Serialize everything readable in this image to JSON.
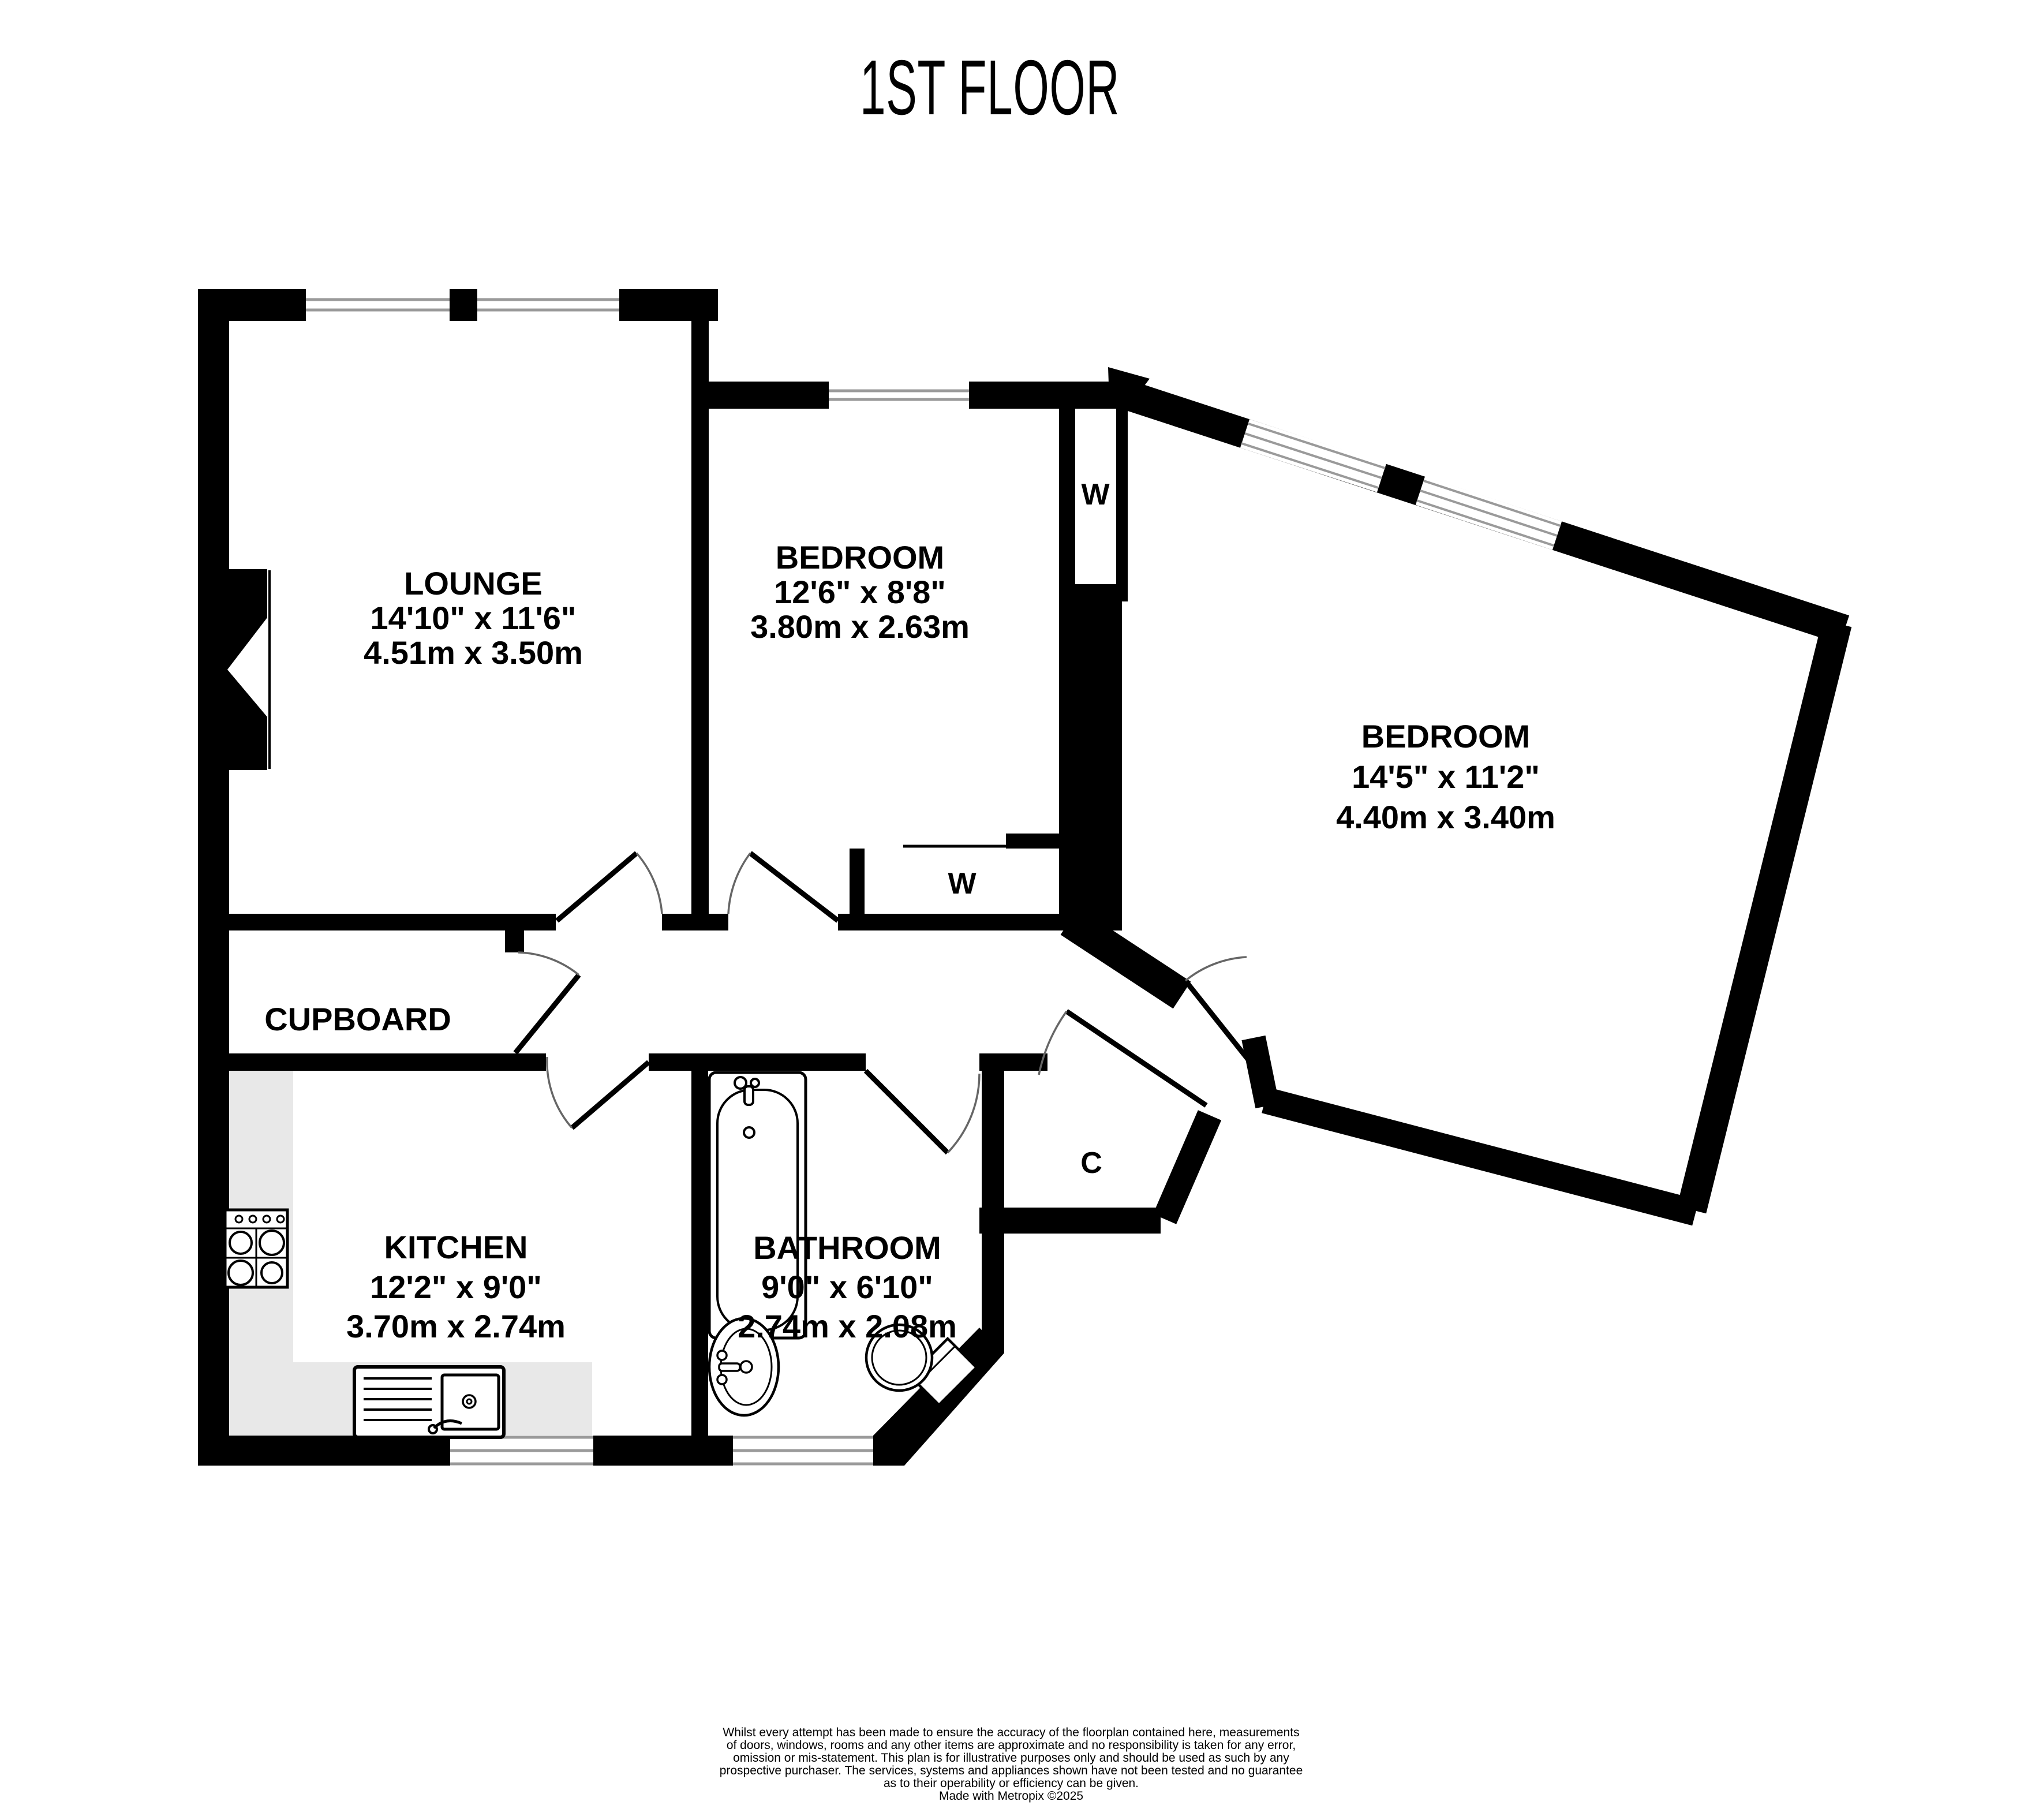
{
  "title": "1ST FLOOR",
  "colors": {
    "wall": "#000000",
    "background": "#ffffff",
    "window_line": "#9a9a9a",
    "door_arc": "#666666",
    "counter": "#e8e8e8",
    "text": "#000000"
  },
  "rooms": [
    {
      "id": "lounge",
      "name": "LOUNGE",
      "imperial": "14'10\"  x 11'6\"",
      "metric": "4.51m  x 3.50m"
    },
    {
      "id": "bedroom1",
      "name": "BEDROOM",
      "imperial": "12'6\"  x 8'8\"",
      "metric": "3.80m  x 2.63m"
    },
    {
      "id": "bedroom2",
      "name": "BEDROOM",
      "imperial": "14'5\"  x 11'2\"",
      "metric": "4.40m  x 3.40m"
    },
    {
      "id": "kitchen",
      "name": "KITCHEN",
      "imperial": "12'2\"  x 9'0\"",
      "metric": "3.70m  x 2.74m"
    },
    {
      "id": "bathroom",
      "name": "BATHROOM",
      "imperial": "9'0\"  x 6'10\"",
      "metric": "2.74m  x 2.08m"
    }
  ],
  "labels": {
    "cupboard": "CUPBOARD"
  },
  "closets": [
    {
      "id": "wardrobe-bedroom2",
      "label": "W"
    },
    {
      "id": "wardrobe-bedroom1",
      "label": "W"
    },
    {
      "id": "cupboard-hall",
      "label": "C"
    }
  ],
  "disclaimer": {
    "lines": [
      "Whilst every attempt has been made to ensure the accuracy of the floorplan contained here, measurements",
      "of doors, windows, rooms and any other items are approximate and no responsibility is taken for any error,",
      "omission or mis-statement. This plan is for illustrative purposes only and should be used as such by any",
      "prospective purchaser. The services, systems and appliances shown have not been tested and no guarantee",
      "as to their operability or efficiency can be given."
    ],
    "credit": "Made with Metropix ©2025"
  }
}
